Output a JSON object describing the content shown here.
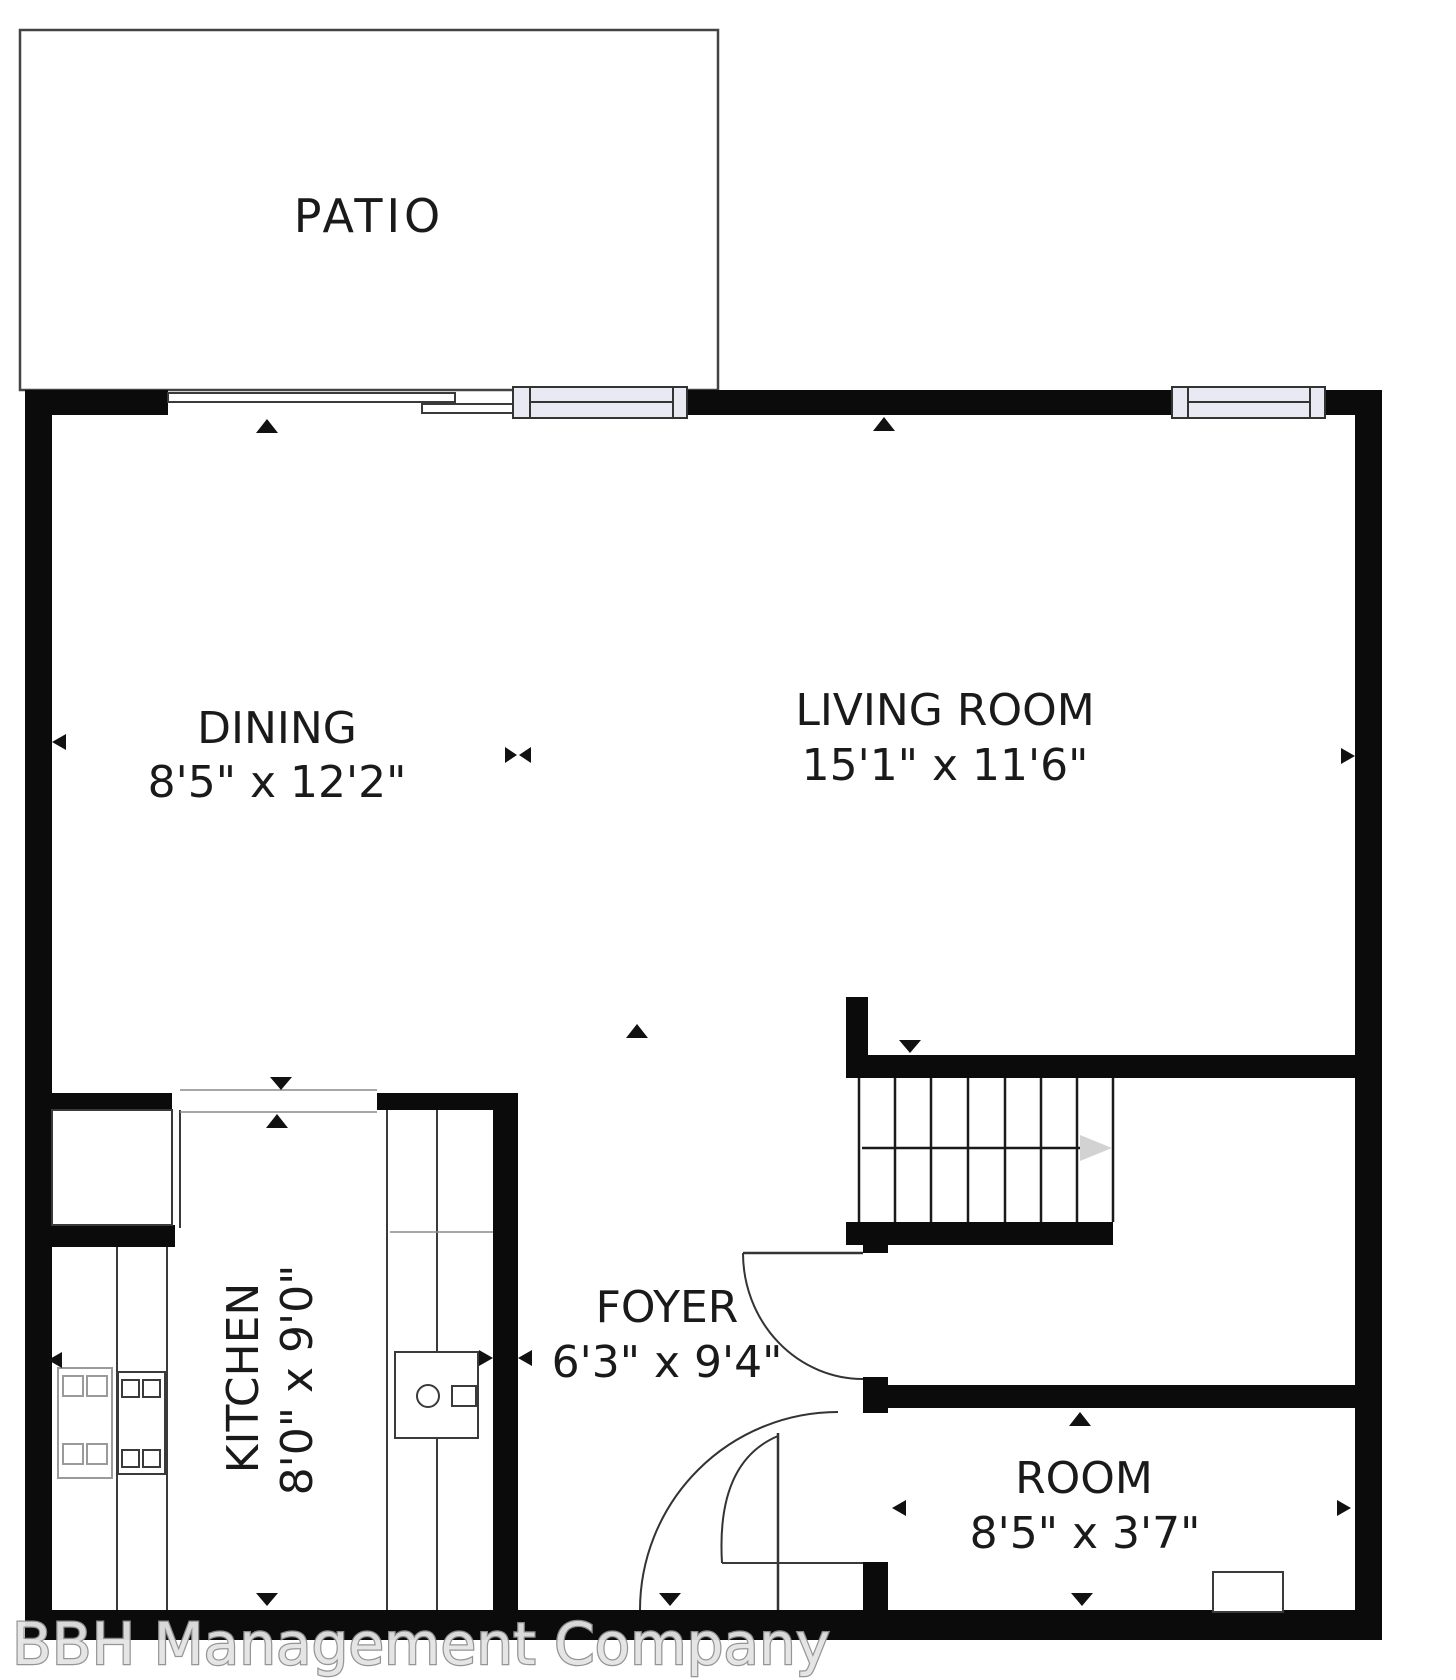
{
  "watermark": {
    "text": "BBH Management Company"
  },
  "rooms": {
    "patio": {
      "label": "PATIO"
    },
    "dining": {
      "label": "DINING",
      "dims": "8'5\" x 12'2\""
    },
    "living_room": {
      "label": "LIVING ROOM",
      "dims": "15'1\" x 11'6\""
    },
    "kitchen": {
      "label": "KITCHEN",
      "dims": "8'0\" x 9'0\""
    },
    "foyer": {
      "label": "FOYER",
      "dims": "6'3\" x 9'4\""
    },
    "room": {
      "label": "ROOM",
      "dims": "8'5\" x 3'7\""
    }
  },
  "colors": {
    "wall": "#0b0b0b",
    "window_fill": "#e9e9f3",
    "stair_arrow": "#d2d2d2",
    "watermark_fill": "#e4e4e4",
    "watermark_stroke": "#909090"
  }
}
